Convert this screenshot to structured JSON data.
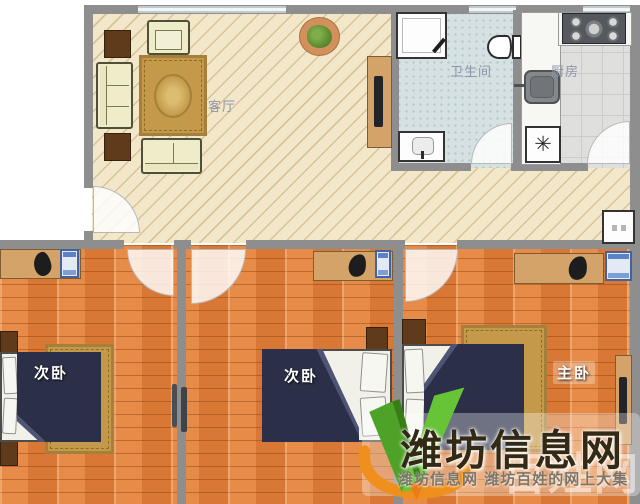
{
  "rooms": {
    "living_room": {
      "label": "客厅"
    },
    "bathroom": {
      "label": "卫生间"
    },
    "kitchen": {
      "label": "厨房"
    },
    "bedroom_left": {
      "label": "次卧"
    },
    "bedroom_middle": {
      "label": "次卧"
    },
    "bedroom_master": {
      "label": "主卧"
    }
  },
  "fixtures": {
    "washer_glyph": "✳"
  },
  "watermark": {
    "brand_text": "潍坊信息网",
    "tagline_text": "潍坊信息网 潍坊百姓的网上大集",
    "background_text": "百姓网",
    "logo_green": "#5ab52f",
    "logo_orange": "#ef8f1d"
  },
  "palette": {
    "living_floor": "#f3e7ca",
    "bathroom_floor": "#d6e1e3",
    "kitchen_floor": "#dfe0de",
    "bedroom_floor": "#e0843f",
    "wall": "#8e8e8e",
    "blanket_navy": "#2b3048",
    "rug_gold": "#c49a4a",
    "furniture_cream": "#efecca",
    "wood_dark": "#5f3b1c",
    "wood_tan": "#d3a369",
    "room_label_color": "#8d94a8"
  }
}
